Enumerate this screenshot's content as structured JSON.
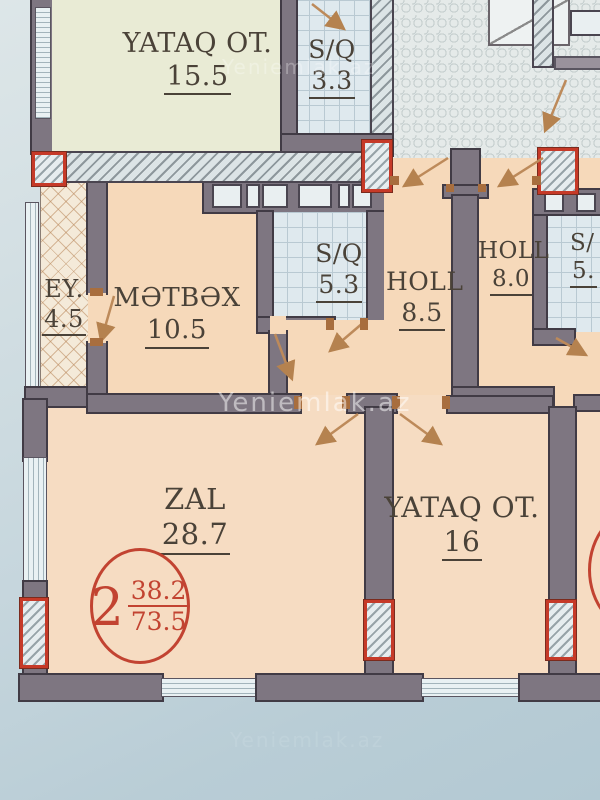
{
  "photo": {
    "watermark": "Yeniemlak.az"
  },
  "plan": {
    "unit_badge": {
      "rooms_count": "2",
      "living_area": "38.2",
      "total_area": "73.5"
    },
    "rooms": [
      {
        "name": "YATAQ OT.",
        "area": "15.5"
      },
      {
        "name": "S/Q",
        "area": "3.3"
      },
      {
        "name": "EY.",
        "area": "4.5"
      },
      {
        "name": "MƏTBƏX",
        "area": "10.5"
      },
      {
        "name": "S/Q",
        "area": "5.3"
      },
      {
        "name": "HOLL",
        "area": "8.5"
      },
      {
        "name": "HOLL",
        "area": "8.0"
      },
      {
        "name": "S/",
        "area": "5."
      },
      {
        "name": "ZAL",
        "area": "28.7"
      },
      {
        "name": "YATAQ OT.",
        "area": "16"
      }
    ]
  }
}
